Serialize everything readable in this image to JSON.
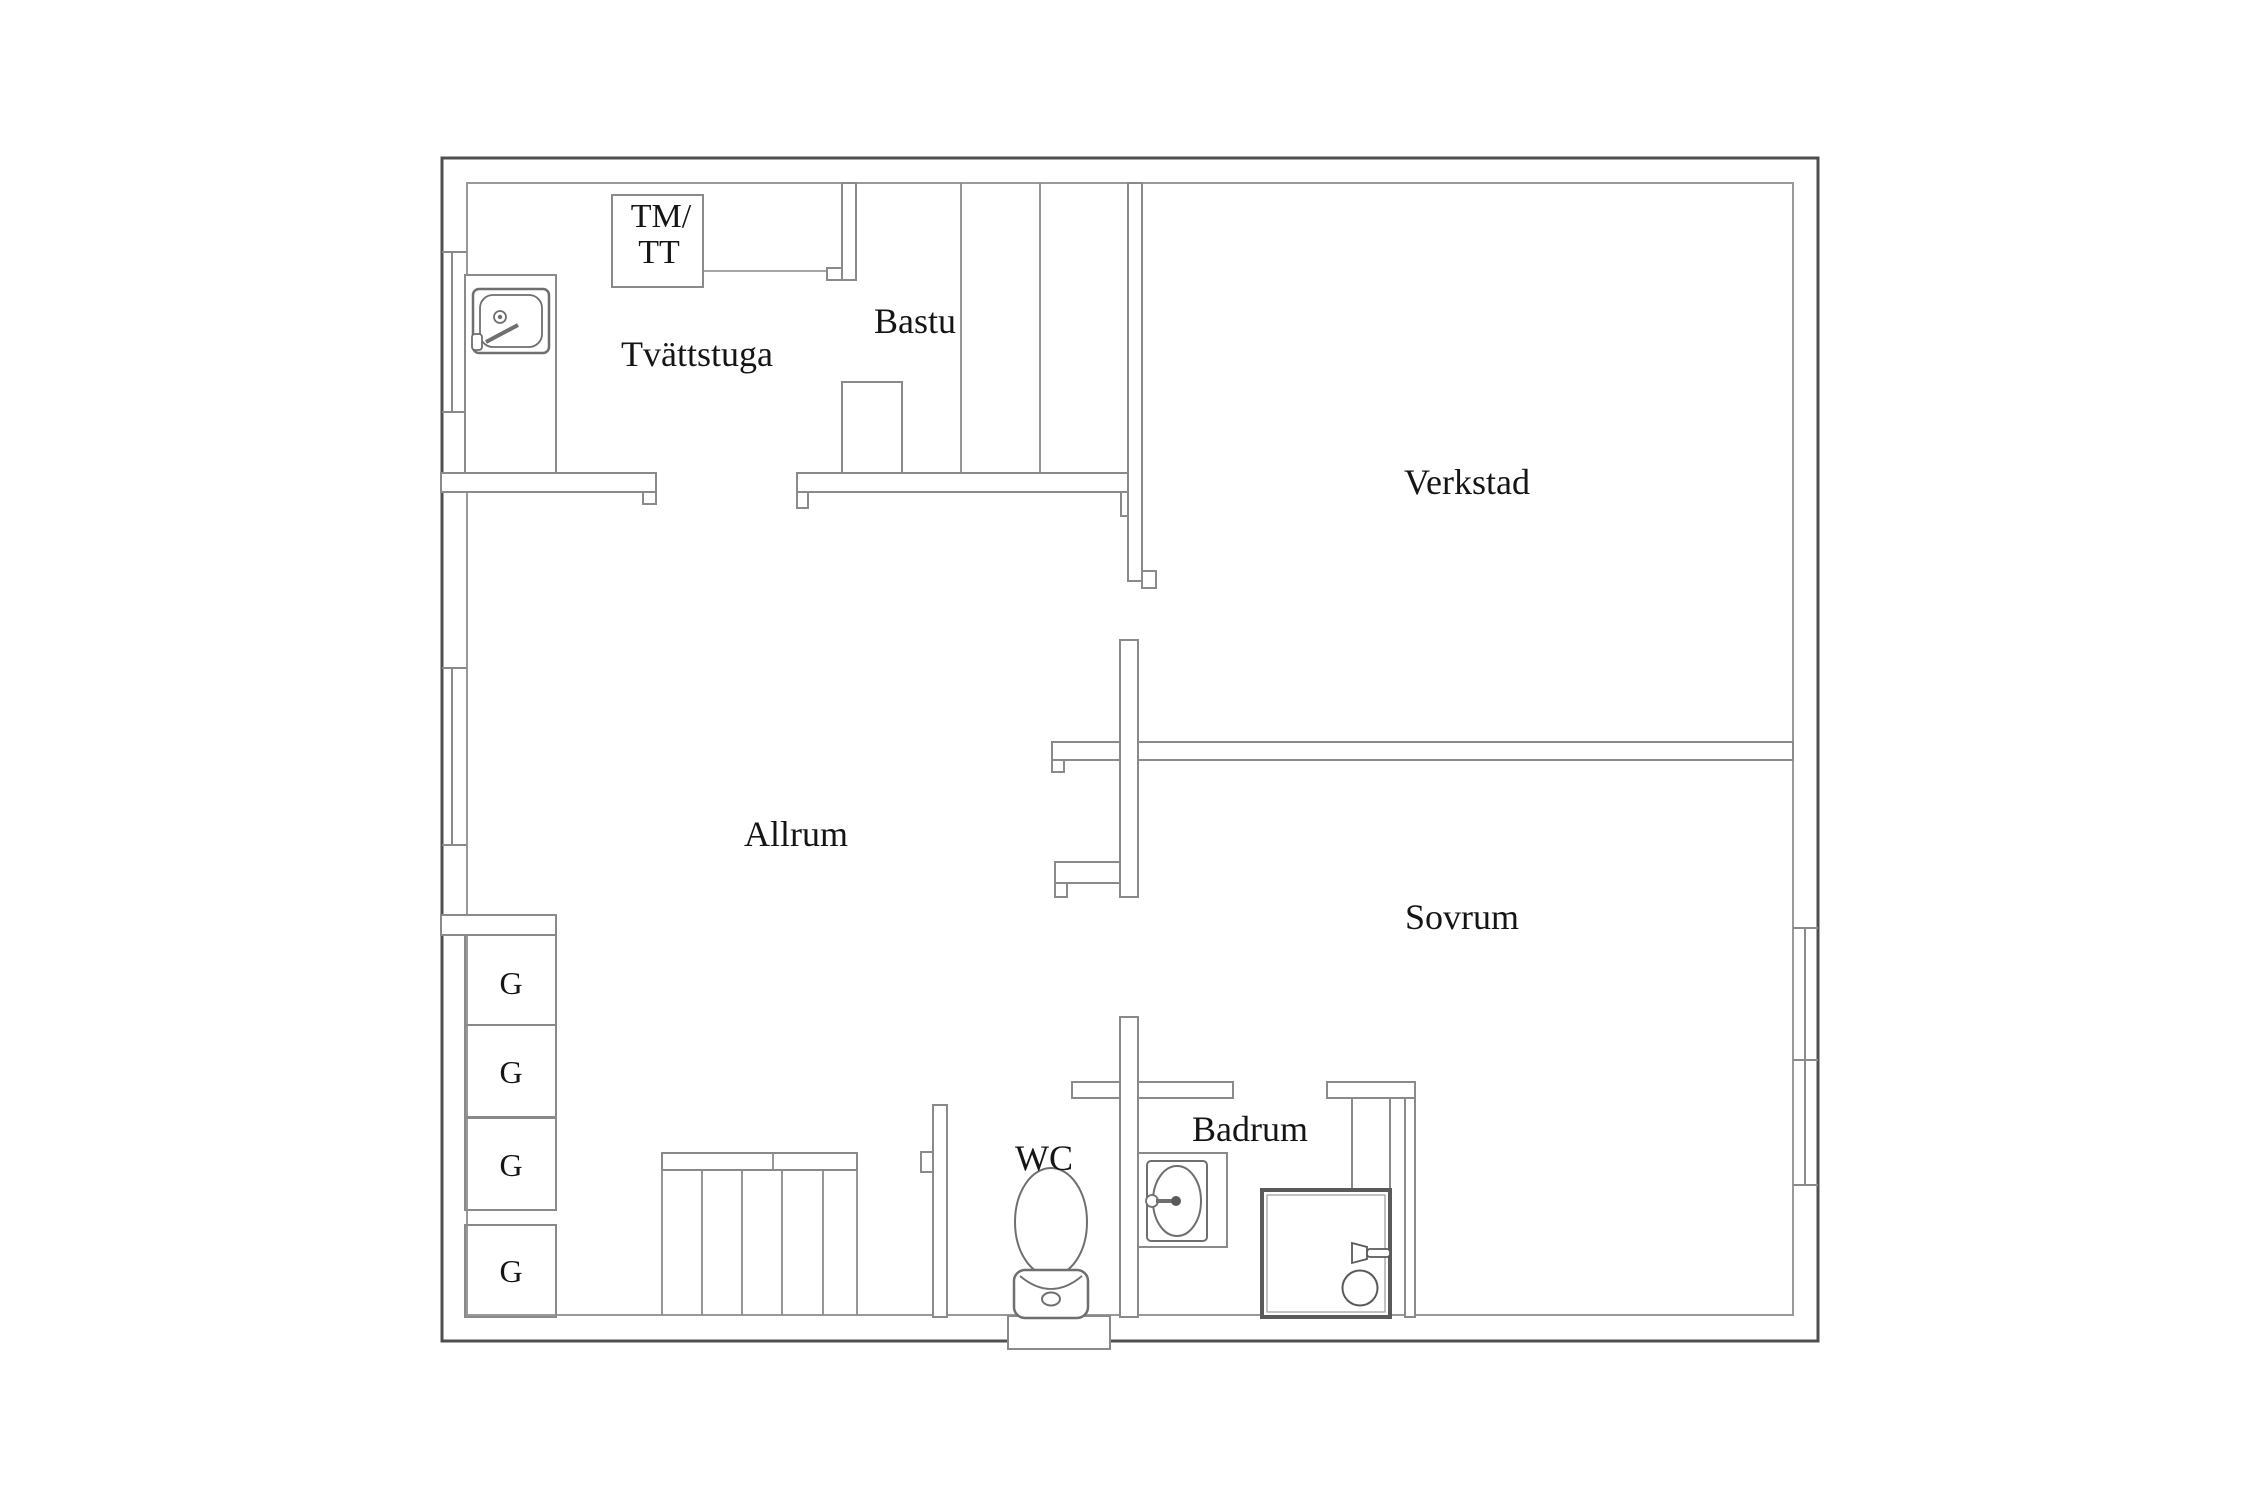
{
  "plan": {
    "type": "floor-plan",
    "background_color": "#ffffff",
    "outer_wall_color": "#4f4f4f",
    "inner_wall_color": "#8a8a8a",
    "text_color": "#151515",
    "rooms": [
      {
        "id": "tvattstuga",
        "label": "Tvättstuga"
      },
      {
        "id": "bastu",
        "label": "Bastu"
      },
      {
        "id": "verkstad",
        "label": "Verkstad"
      },
      {
        "id": "allrum",
        "label": "Allrum"
      },
      {
        "id": "sovrum",
        "label": "Sovrum"
      },
      {
        "id": "wc",
        "label": "WC"
      },
      {
        "id": "badrum",
        "label": "Badrum"
      }
    ],
    "appliance": {
      "id": "washer-dryer",
      "label_line1": "TM/",
      "label_line2": "TT"
    },
    "wardrobes": [
      {
        "label": "G"
      },
      {
        "label": "G"
      },
      {
        "label": "G"
      },
      {
        "label": "G"
      }
    ],
    "fixtures": [
      {
        "name": "laundry-sink",
        "room": "tvattstuga"
      },
      {
        "name": "toilet",
        "room": "wc"
      },
      {
        "name": "washbasin",
        "room": "badrum"
      },
      {
        "name": "shower",
        "room": "badrum"
      }
    ],
    "windows": {
      "left_wall": 2,
      "right_wall": 2
    },
    "stairs": {
      "location": "bottom-center",
      "steps_visible": 5
    }
  }
}
